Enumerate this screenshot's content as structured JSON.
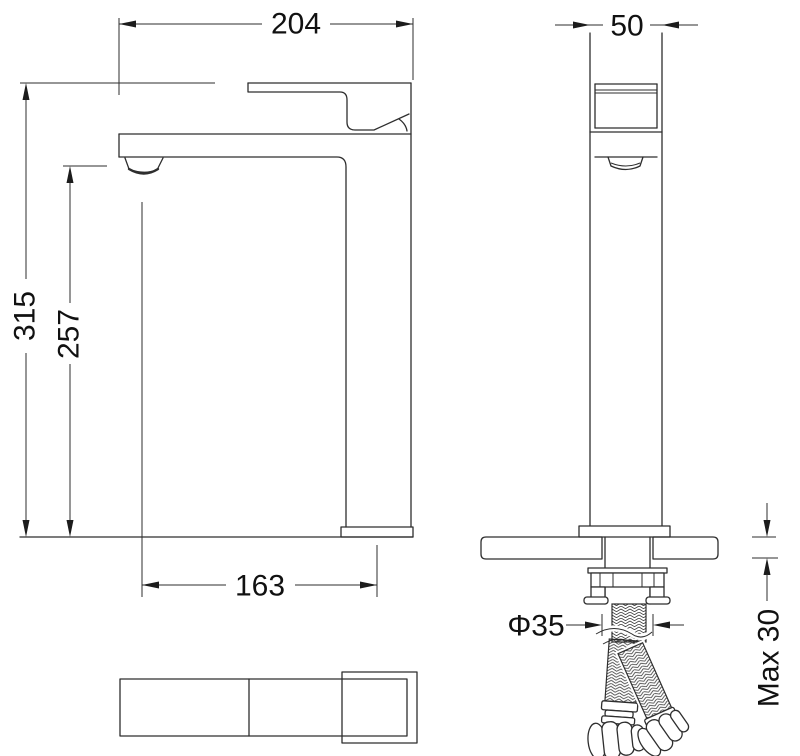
{
  "drawing": {
    "dims": {
      "spout_overall_width": "204",
      "body_width": "50",
      "total_height": "315",
      "outlet_height": "257",
      "spout_reach": "163",
      "mounting_hole_diameter": "Φ35",
      "max_deck_thickness": "Max 30"
    }
  }
}
